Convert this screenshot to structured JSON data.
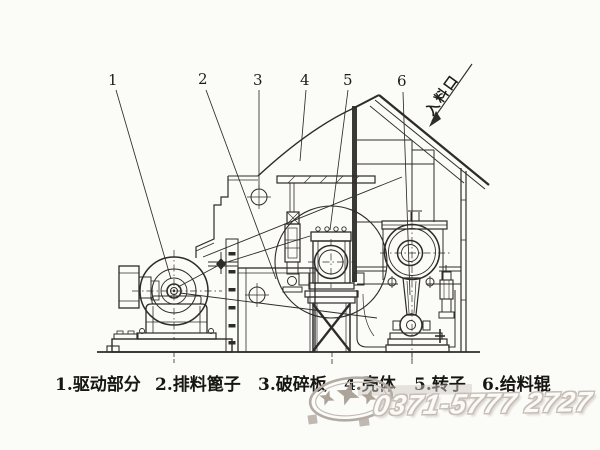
{
  "figure": {
    "callout_numbers": [
      "1",
      "2",
      "3",
      "4",
      "5",
      "6"
    ],
    "inlet_label": "入料口",
    "legend": [
      "1.驱动部分",
      "2.排料篦子",
      "3.破碎板",
      "4.壳体",
      "5.转子",
      "6.给料辊"
    ]
  },
  "watermark": {
    "phone": "0371-5777 2727"
  },
  "colors": {
    "ink": "#2e2c2a",
    "background": "#fbfbf8",
    "watermark_gray": "#b3aaa2"
  }
}
